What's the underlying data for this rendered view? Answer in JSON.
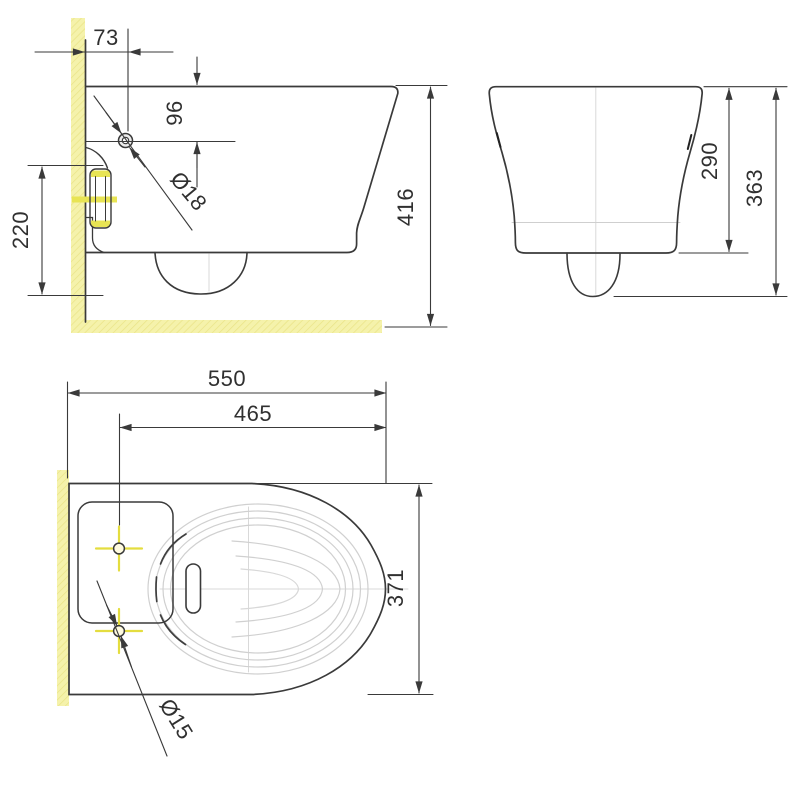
{
  "drawing": {
    "title": "Wall-hung toilet installation dimensions",
    "views": [
      {
        "id": "side",
        "name": "side-elevation-section"
      },
      {
        "id": "front",
        "name": "front-elevation"
      },
      {
        "id": "plan",
        "name": "plan-top-view"
      }
    ],
    "labels": {
      "d73": "73",
      "d96": "96",
      "d18": "Ø18",
      "d220": "220",
      "d416": "416",
      "d290": "290",
      "d363": "363",
      "d550": "550",
      "d465": "465",
      "d371": "371",
      "d15": "Ø15"
    },
    "colors": {
      "line": "#3a3a3a",
      "bowl_line": "#d0d0d0",
      "centerline": "#d9d9d9",
      "wall_hatch": "#f5f2ab",
      "wall_hatch_line": "#e9e387",
      "highlight": "#e4dd3f"
    }
  }
}
